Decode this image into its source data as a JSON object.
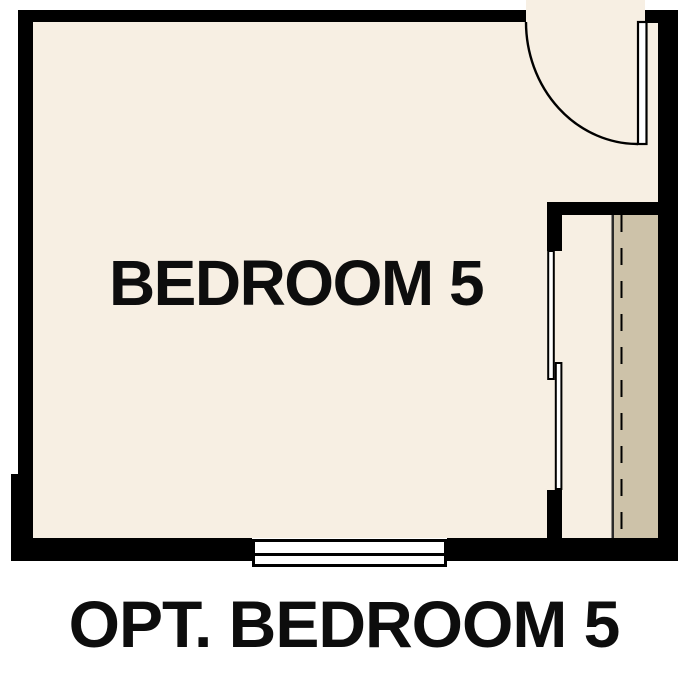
{
  "floorplan": {
    "room_label": "BEDROOM 5",
    "caption": "OPT. BEDROOM 5",
    "features": {
      "entry_door": "hinged door with quarter-circle swing, top right",
      "closet_doors": "two offset bypass sliding panels, right side",
      "window": "bottom center wall",
      "closet_shelf": "tan strip with dashed rod line along right wall"
    }
  },
  "colors": {
    "wall": "#000000",
    "floor": "#f7efe3",
    "closet_shelf": "#cdc2a9",
    "fixture_white": "#ffffff",
    "text": "#0d0d0d",
    "background": "#ffffff"
  }
}
